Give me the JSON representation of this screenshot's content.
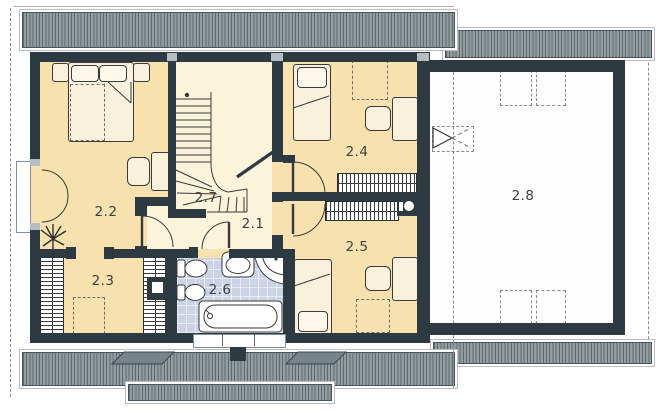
{
  "rooms": {
    "r21": {
      "label": "2.1"
    },
    "r22": {
      "label": "2.2"
    },
    "r23": {
      "label": "2.3"
    },
    "r24": {
      "label": "2.4"
    },
    "r25": {
      "label": "2.5"
    },
    "r26": {
      "label": "2.6"
    },
    "r27": {
      "label": "2.7"
    },
    "r28": {
      "label": "2.8"
    }
  },
  "colors": {
    "wall": "#2e3a41",
    "room": "#f7e1ae",
    "hall": "#fcf4da",
    "bath": "#cdd3e7",
    "garage": "#fefefe",
    "roof-base": "#929d9f",
    "roof-stripe": "#5d6b6e",
    "label": "#3f3f3f",
    "fix": "#3a3a3a"
  }
}
